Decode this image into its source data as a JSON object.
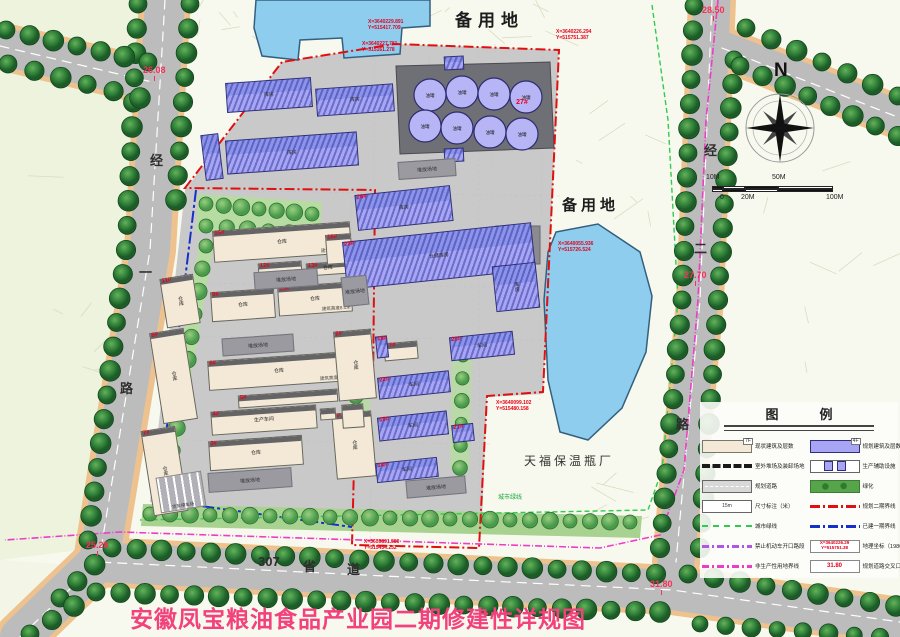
{
  "title": {
    "text": "安徽凤宝粮油食品产业园二期修建性详规图",
    "color": "#f2417c"
  },
  "compass": {
    "label": "N"
  },
  "scale_bar": {
    "top_labels": [
      "10M",
      "50M"
    ],
    "bottom_labels": [
      "0",
      "20M",
      "100M"
    ]
  },
  "area_labels": [
    {
      "text": "备用地",
      "x": 455,
      "y": 6,
      "size": 17,
      "ls": 6
    },
    {
      "text": "备用地",
      "x": 562,
      "y": 194,
      "size": 15,
      "ls": 4
    }
  ],
  "factory_label": "天福保温瓶厂",
  "green_line_label": "城市绿线",
  "yard_label": "堆放场地",
  "parking": {
    "label": "货车停车场",
    "x": 158,
    "y": 474,
    "w": 46,
    "h": 36,
    "rot": -9
  },
  "road_labels": [
    {
      "ch": "经",
      "x": 150,
      "y": 150
    },
    {
      "ch": "一",
      "x": 139,
      "y": 262
    },
    {
      "ch": "路",
      "x": 120,
      "y": 378
    },
    {
      "ch": "经",
      "x": 704,
      "y": 140
    },
    {
      "ch": "二",
      "x": 694,
      "y": 238
    },
    {
      "ch": "路",
      "x": 676,
      "y": 414
    },
    {
      "ch": "307",
      "x": 258,
      "y": 554
    },
    {
      "ch": "省",
      "x": 303,
      "y": 556
    },
    {
      "ch": "道",
      "x": 347,
      "y": 559
    }
  ],
  "elevation_markers": [
    {
      "value": "26.08",
      "x": 143,
      "y": 66
    },
    {
      "value": "28.50",
      "x": 702,
      "y": 6
    },
    {
      "value": "27.70",
      "x": 684,
      "y": 271
    },
    {
      "value": "25.28",
      "x": 86,
      "y": 541
    },
    {
      "value": "31.80",
      "x": 650,
      "y": 580
    }
  ],
  "coordinate_markers": [
    {
      "line1": "X=3640229.891",
      "line2": "Y=515417.709",
      "x": 368,
      "y": 20
    },
    {
      "line1": "X=3640227.781",
      "line2": "Y=515161.278",
      "x": 362,
      "y": 42
    },
    {
      "line1": "X=3640226.294",
      "line2": "Y=515751.387",
      "x": 556,
      "y": 30
    },
    {
      "line1": "X=3640055.936",
      "line2": "Y=515726.524",
      "x": 558,
      "y": 242
    },
    {
      "line1": "X=3640099.102",
      "line2": "Y=515480.158",
      "x": 496,
      "y": 401
    },
    {
      "line1": "X=3639891.580",
      "line2": "Y=515434.232",
      "x": 364,
      "y": 540
    }
  ],
  "legend": {
    "title": "图　例",
    "rows_left": [
      {
        "swatch": "existing-building",
        "tag": "7F",
        "label": "现状建筑及层数"
      },
      {
        "swatch": "outdoor-yard",
        "label": "室外堆场及装卸场地"
      },
      {
        "swatch": "planned-road",
        "label": "规划道路"
      },
      {
        "swatch": "dimension",
        "sample": "15m",
        "label": "尺寸标注（米）"
      },
      {
        "swatch": "green-line",
        "label": "城市绿线"
      },
      {
        "swatch": "no-vehicle-line",
        "label": "禁止机动车开口路段"
      },
      {
        "swatch": "nonproduction-line",
        "label": "非生产性用地界线"
      }
    ],
    "rows_right": [
      {
        "swatch": "planned-building",
        "tag": "4F",
        "label": "规划建筑及层数"
      },
      {
        "swatch": "aux-facility",
        "label": "生产辅助设施"
      },
      {
        "swatch": "greening",
        "label": "绿化"
      },
      {
        "swatch": "phase2-line",
        "label": "规划二期界线"
      },
      {
        "swatch": "phase1-line",
        "label": "已建一期界线"
      },
      {
        "swatch": "geo-coord",
        "sample": "X=3640226.29\nY=515751.38",
        "label": "地理坐标（1980西安坐标）"
      },
      {
        "swatch": "elevation",
        "sample": "31.80",
        "label": "规划道路交叉口标高"
      }
    ]
  },
  "tanks": {
    "group_label": "27#",
    "unit_label": "油罐",
    "units": [
      [
        430,
        95
      ],
      [
        462,
        92
      ],
      [
        494,
        94
      ],
      [
        526,
        97
      ],
      [
        425,
        126
      ],
      [
        457,
        128
      ],
      [
        490,
        132
      ],
      [
        522,
        134
      ]
    ]
  },
  "buildings": {
    "existing": [
      {
        "id": "15#",
        "name": "仓库",
        "sub": "建筑高度8.1米",
        "x": 213,
        "y": 226,
        "w": 138,
        "h": 32,
        "rot": -4
      },
      {
        "id": "12#",
        "name": "",
        "x": 258,
        "y": 262,
        "w": 44,
        "h": 13,
        "rot": -4
      },
      {
        "id": "13#",
        "name": "仓库",
        "x": 306,
        "y": 262,
        "w": 44,
        "h": 13,
        "rot": -4
      },
      {
        "id": "16#",
        "name": "",
        "x": 326,
        "y": 234,
        "w": 26,
        "h": 30,
        "rot": -4
      },
      {
        "id": "9#",
        "name": "仓库",
        "x": 211,
        "y": 290,
        "w": 64,
        "h": 30,
        "rot": -4
      },
      {
        "id": "10#",
        "name": "仓库",
        "sub": "建筑高度8.1米",
        "x": 278,
        "y": 284,
        "w": 74,
        "h": 30,
        "rot": -4
      },
      {
        "id": "11#",
        "name": "仓库",
        "x": 163,
        "y": 276,
        "w": 34,
        "h": 50,
        "rot": -9,
        "vert": true
      },
      {
        "id": "8#",
        "name": "仓库",
        "x": 156,
        "y": 330,
        "w": 35,
        "h": 92,
        "rot": -9,
        "vert": true
      },
      {
        "id": "7#",
        "name": "仓库",
        "x": 147,
        "y": 428,
        "w": 35,
        "h": 86,
        "rot": -9,
        "vert": true
      },
      {
        "id": "6#",
        "name": "仓库",
        "sub": "建筑高度8.1米",
        "x": 208,
        "y": 356,
        "w": 142,
        "h": 30,
        "rot": -4
      },
      {
        "id": "5#",
        "name": "",
        "x": 238,
        "y": 392,
        "w": 100,
        "h": 13,
        "rot": -4
      },
      {
        "id": "4#",
        "name": "生产车间",
        "x": 211,
        "y": 408,
        "w": 106,
        "h": 24,
        "rot": -4
      },
      {
        "id": "3#",
        "name": "仓库",
        "x": 209,
        "y": 438,
        "w": 94,
        "h": 30,
        "rot": -4
      },
      {
        "id": "2#",
        "name": "仓库",
        "x": 336,
        "y": 330,
        "w": 38,
        "h": 70,
        "rot": -5,
        "vert": true
      },
      {
        "id": "1#",
        "name": "仓库",
        "x": 334,
        "y": 412,
        "w": 40,
        "h": 66,
        "rot": -5,
        "vert": true
      },
      {
        "id": "17#",
        "name": "",
        "x": 384,
        "y": 342,
        "w": 34,
        "h": 18,
        "rot": -5
      },
      {
        "id": "",
        "name": "",
        "x": 320,
        "y": 408,
        "w": 16,
        "h": 12,
        "rot": -4
      },
      {
        "id": "",
        "name": "",
        "x": 342,
        "y": 404,
        "w": 22,
        "h": 24,
        "rot": -4
      }
    ],
    "planned": [
      {
        "id": "",
        "name": "库房",
        "x": 226,
        "y": 80,
        "w": 86,
        "h": 30,
        "rot": -4
      },
      {
        "id": "",
        "name": "库房",
        "x": 316,
        "y": 86,
        "w": 78,
        "h": 28,
        "rot": -4
      },
      {
        "id": "",
        "name": "库房",
        "x": 226,
        "y": 136,
        "w": 132,
        "h": 34,
        "rot": -4
      },
      {
        "id": "",
        "name": "",
        "x": 203,
        "y": 134,
        "w": 18,
        "h": 46,
        "rot": -7,
        "vert": true
      },
      {
        "id": "26#",
        "name": "库房",
        "x": 356,
        "y": 190,
        "w": 96,
        "h": 36,
        "rot": -6
      },
      {
        "id": "23#",
        "name": "仓储库房",
        "x": 344,
        "y": 232,
        "w": 190,
        "h": 48,
        "rot": -6
      },
      {
        "id": "",
        "name": "库房",
        "x": 494,
        "y": 264,
        "w": 44,
        "h": 46,
        "rot": -6,
        "vert": true
      },
      {
        "id": "20#",
        "name": "车间",
        "x": 450,
        "y": 334,
        "w": 64,
        "h": 24,
        "rot": -6
      },
      {
        "id": "22#",
        "name": "车间",
        "x": 378,
        "y": 374,
        "w": 72,
        "h": 22,
        "rot": -6
      },
      {
        "id": "19#",
        "name": "车间",
        "x": 378,
        "y": 414,
        "w": 70,
        "h": 24,
        "rot": -6
      },
      {
        "id": "21#",
        "name": "",
        "x": 452,
        "y": 424,
        "w": 22,
        "h": 18,
        "rot": -6
      },
      {
        "id": "14#",
        "name": "车间",
        "x": 376,
        "y": 460,
        "w": 62,
        "h": 20,
        "rot": -6
      },
      {
        "id": "18#",
        "name": "",
        "x": 376,
        "y": 336,
        "w": 12,
        "h": 22,
        "rot": -6,
        "vert": true
      },
      {
        "id": "",
        "name": "",
        "x": 444,
        "y": 56,
        "w": 20,
        "h": 14,
        "rot": -3
      },
      {
        "id": "",
        "name": "",
        "x": 444,
        "y": 148,
        "w": 20,
        "h": 14,
        "rot": -3
      }
    ]
  },
  "yards": [
    {
      "x": 398,
      "y": 160,
      "w": 58,
      "h": 18,
      "rot": -4
    },
    {
      "x": 254,
      "y": 270,
      "w": 64,
      "h": 18,
      "rot": -4
    },
    {
      "x": 342,
      "y": 276,
      "w": 26,
      "h": 30,
      "rot": -6
    },
    {
      "x": 222,
      "y": 336,
      "w": 72,
      "h": 18,
      "rot": -4
    },
    {
      "x": 208,
      "y": 470,
      "w": 84,
      "h": 20,
      "rot": -4
    },
    {
      "x": 406,
      "y": 478,
      "w": 60,
      "h": 18,
      "rot": -5
    }
  ],
  "tree_lines": [
    {
      "pts": [
        [
          138,
          4
        ],
        [
          126,
          250
        ],
        [
          88,
          540
        ]
      ],
      "gap": 24,
      "r": 9,
      "kind": "street"
    },
    {
      "pts": [
        [
          190,
          4
        ],
        [
          176,
          200
        ]
      ],
      "gap": 24,
      "r": 9,
      "kind": "street"
    },
    {
      "pts": [
        [
          6,
          30
        ],
        [
          148,
          62
        ]
      ],
      "gap": 26,
      "r": 9,
      "kind": "street"
    },
    {
      "pts": [
        [
          8,
          64
        ],
        [
          140,
          98
        ]
      ],
      "gap": 26,
      "r": 9,
      "kind": "street"
    },
    {
      "pts": [
        [
          694,
          6
        ],
        [
          682,
          300
        ],
        [
          660,
          548
        ]
      ],
      "gap": 24,
      "r": 9,
      "kind": "street"
    },
    {
      "pts": [
        [
          734,
          60
        ],
        [
          718,
          300
        ],
        [
          700,
          548
        ]
      ],
      "gap": 24,
      "r": 9,
      "kind": "street"
    },
    {
      "pts": [
        [
          746,
          28
        ],
        [
          898,
          96
        ]
      ],
      "gap": 26,
      "r": 9,
      "kind": "street"
    },
    {
      "pts": [
        [
          740,
          66
        ],
        [
          898,
          136
        ]
      ],
      "gap": 26,
      "r": 9,
      "kind": "street"
    },
    {
      "pts": [
        [
          60,
          598
        ],
        [
          112,
          548
        ],
        [
          656,
          574
        ]
      ],
      "gap": 25,
      "r": 9,
      "kind": "street"
    },
    {
      "pts": [
        [
          30,
          634
        ],
        [
          96,
          592
        ],
        [
          660,
          612
        ]
      ],
      "gap": 25,
      "r": 9,
      "kind": "street"
    },
    {
      "pts": [
        [
          688,
          574
        ],
        [
          896,
          606
        ]
      ],
      "gap": 25,
      "r": 9,
      "kind": "street"
    },
    {
      "pts": [
        [
          700,
          624
        ],
        [
          880,
          637
        ]
      ],
      "gap": 26,
      "r": 8,
      "kind": "street"
    },
    {
      "pts": [
        [
          150,
          514
        ],
        [
          630,
          522
        ]
      ],
      "gap": 20,
      "r": 7,
      "kind": "park"
    },
    {
      "pts": [
        [
          206,
          204
        ],
        [
          312,
          214
        ]
      ],
      "gap": 19,
      "r": 7,
      "kind": "park"
    },
    {
      "pts": [
        [
          206,
          226
        ],
        [
          310,
          234
        ]
      ],
      "gap": 21,
      "r": 7,
      "kind": "park"
    },
    {
      "pts": [
        [
          206,
          246
        ],
        [
          166,
          496
        ]
      ],
      "gap": 24,
      "r": 7,
      "kind": "park"
    },
    {
      "pts": [
        [
          357,
          350
        ],
        [
          354,
          466
        ]
      ],
      "gap": 22,
      "r": 6,
      "kind": "park"
    },
    {
      "pts": [
        [
          463,
          356
        ],
        [
          460,
          468
        ]
      ],
      "gap": 23,
      "r": 6,
      "kind": "park"
    }
  ],
  "colors": {
    "road": "#bcbcbc",
    "sidewalk": "#eec28e",
    "water": "#8ecdee",
    "site": "#c9c9c9",
    "green": "#b7dca2",
    "phase2": "#e01010",
    "phase1": "#1530c8",
    "green_line": "#2ecc4e",
    "magenta_line": "#ee3cc8",
    "existing_building": "#f3e9d6",
    "planned_building": "#a7a5f4"
  }
}
